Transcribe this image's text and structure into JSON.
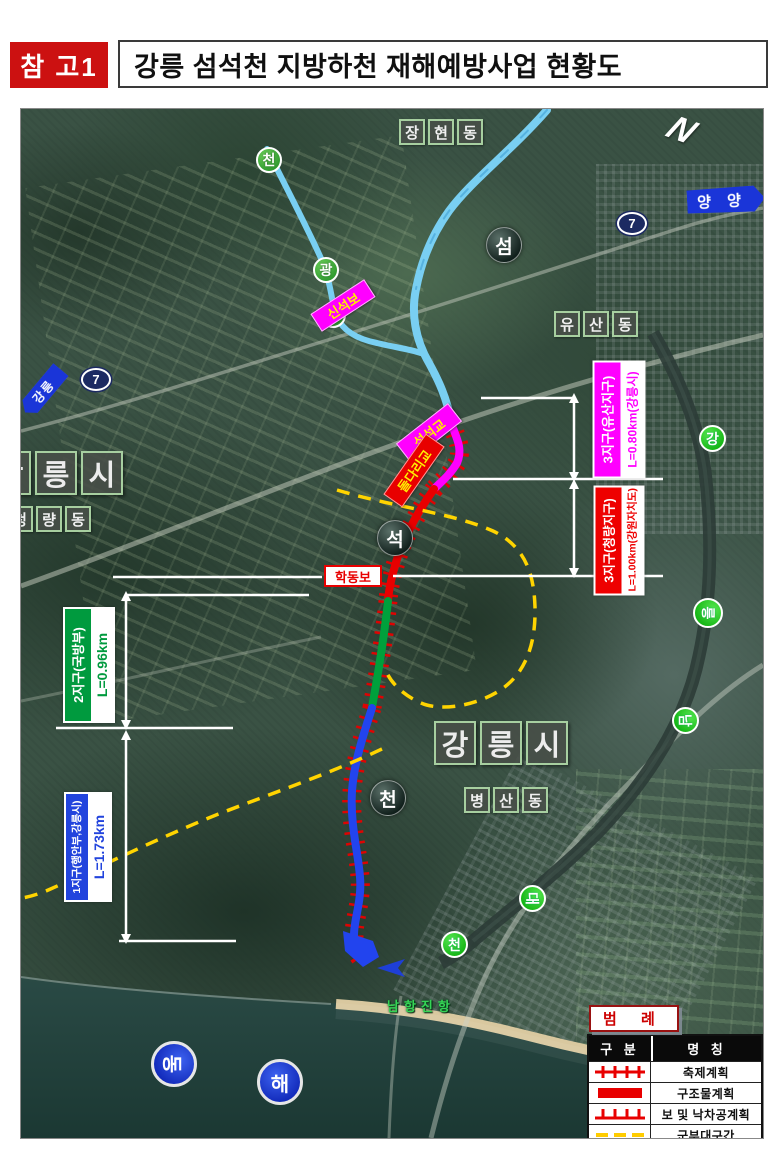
{
  "header": {
    "ref_label": "참 고1",
    "title": "강릉 섬석천 지방하천 재해예방사업 현황도"
  },
  "colors": {
    "zone3_yusan": "#ff00ff",
    "zone3_cheongnyang": "#ee0000",
    "zone2_defense": "#009a3e",
    "zone1_interior": "#2244dd",
    "military_dash": "#ffd400",
    "river_blue": "#79cff2",
    "sign_blue": "#1a35d8"
  },
  "map": {
    "compass": "N",
    "area_labels": [
      {
        "name": "janghyeon-dong",
        "chars": [
          "장",
          "현",
          "동"
        ]
      },
      {
        "name": "yusan-dong",
        "chars": [
          "유",
          "산",
          "동"
        ]
      },
      {
        "name": "cheongnyang-dong",
        "chars": [
          "청",
          "량",
          "동"
        ]
      },
      {
        "name": "byeongsan-dong",
        "chars": [
          "병",
          "산",
          "동"
        ]
      }
    ],
    "city_labels": [
      {
        "name": "gangneung-city-west",
        "chars": [
          "강",
          "릉",
          "시"
        ]
      },
      {
        "name": "gangneung-city-south",
        "chars": [
          "강",
          "릉",
          "시"
        ]
      }
    ],
    "stream_circles": [
      "천",
      "광",
      "금"
    ],
    "dark_circles": [
      "섬",
      "석",
      "천"
    ],
    "river_circles": [
      "강",
      "릉",
      "남",
      "대",
      "천"
    ],
    "sea_circles": [
      "동",
      "해"
    ],
    "road_shields": [
      "7",
      "7"
    ],
    "direction_signs": [
      {
        "name": "yangyang",
        "label": "양 양"
      },
      {
        "name": "gangneung",
        "label": "강릉"
      }
    ],
    "structures": [
      {
        "name": "sinseok-weir",
        "label": "신석보"
      },
      {
        "name": "seomseok-bridge",
        "label": "섬석교"
      },
      {
        "name": "doldari-bridge",
        "label": "돌다리교"
      },
      {
        "name": "hakdong-weir",
        "label": "학동보"
      }
    ],
    "port_label": "남항진항"
  },
  "callouts": [
    {
      "id": "zone3-yusan",
      "line1": "3지구(유산지구)",
      "line2": "L=0.80km(강릉시)",
      "color": "#ff00ff"
    },
    {
      "id": "zone3-cheongnyang",
      "line1": "3지구(청량지구)",
      "line2": "L=1.00km(강원자치도)",
      "color": "#ee0000"
    },
    {
      "id": "zone2-defense",
      "line1": "2지구(국방부)",
      "line2": "L=0.96km",
      "color": "#009a3e"
    },
    {
      "id": "zone1-interior",
      "line1": "1지구(행안부,강릉시)",
      "line2": "L=1.73km",
      "color": "#2244dd"
    }
  ],
  "legend": {
    "title": "범 례",
    "col_type": "구 분",
    "col_name": "명 칭",
    "rows": [
      {
        "symbol": "tick-cross-red",
        "name": "축제계획"
      },
      {
        "symbol": "solid-red",
        "name": "구조물계획"
      },
      {
        "symbol": "tick-up-red",
        "name": "보 및 낙차공계획"
      },
      {
        "symbol": "dash-yellow",
        "name": "군부대구간"
      }
    ]
  }
}
